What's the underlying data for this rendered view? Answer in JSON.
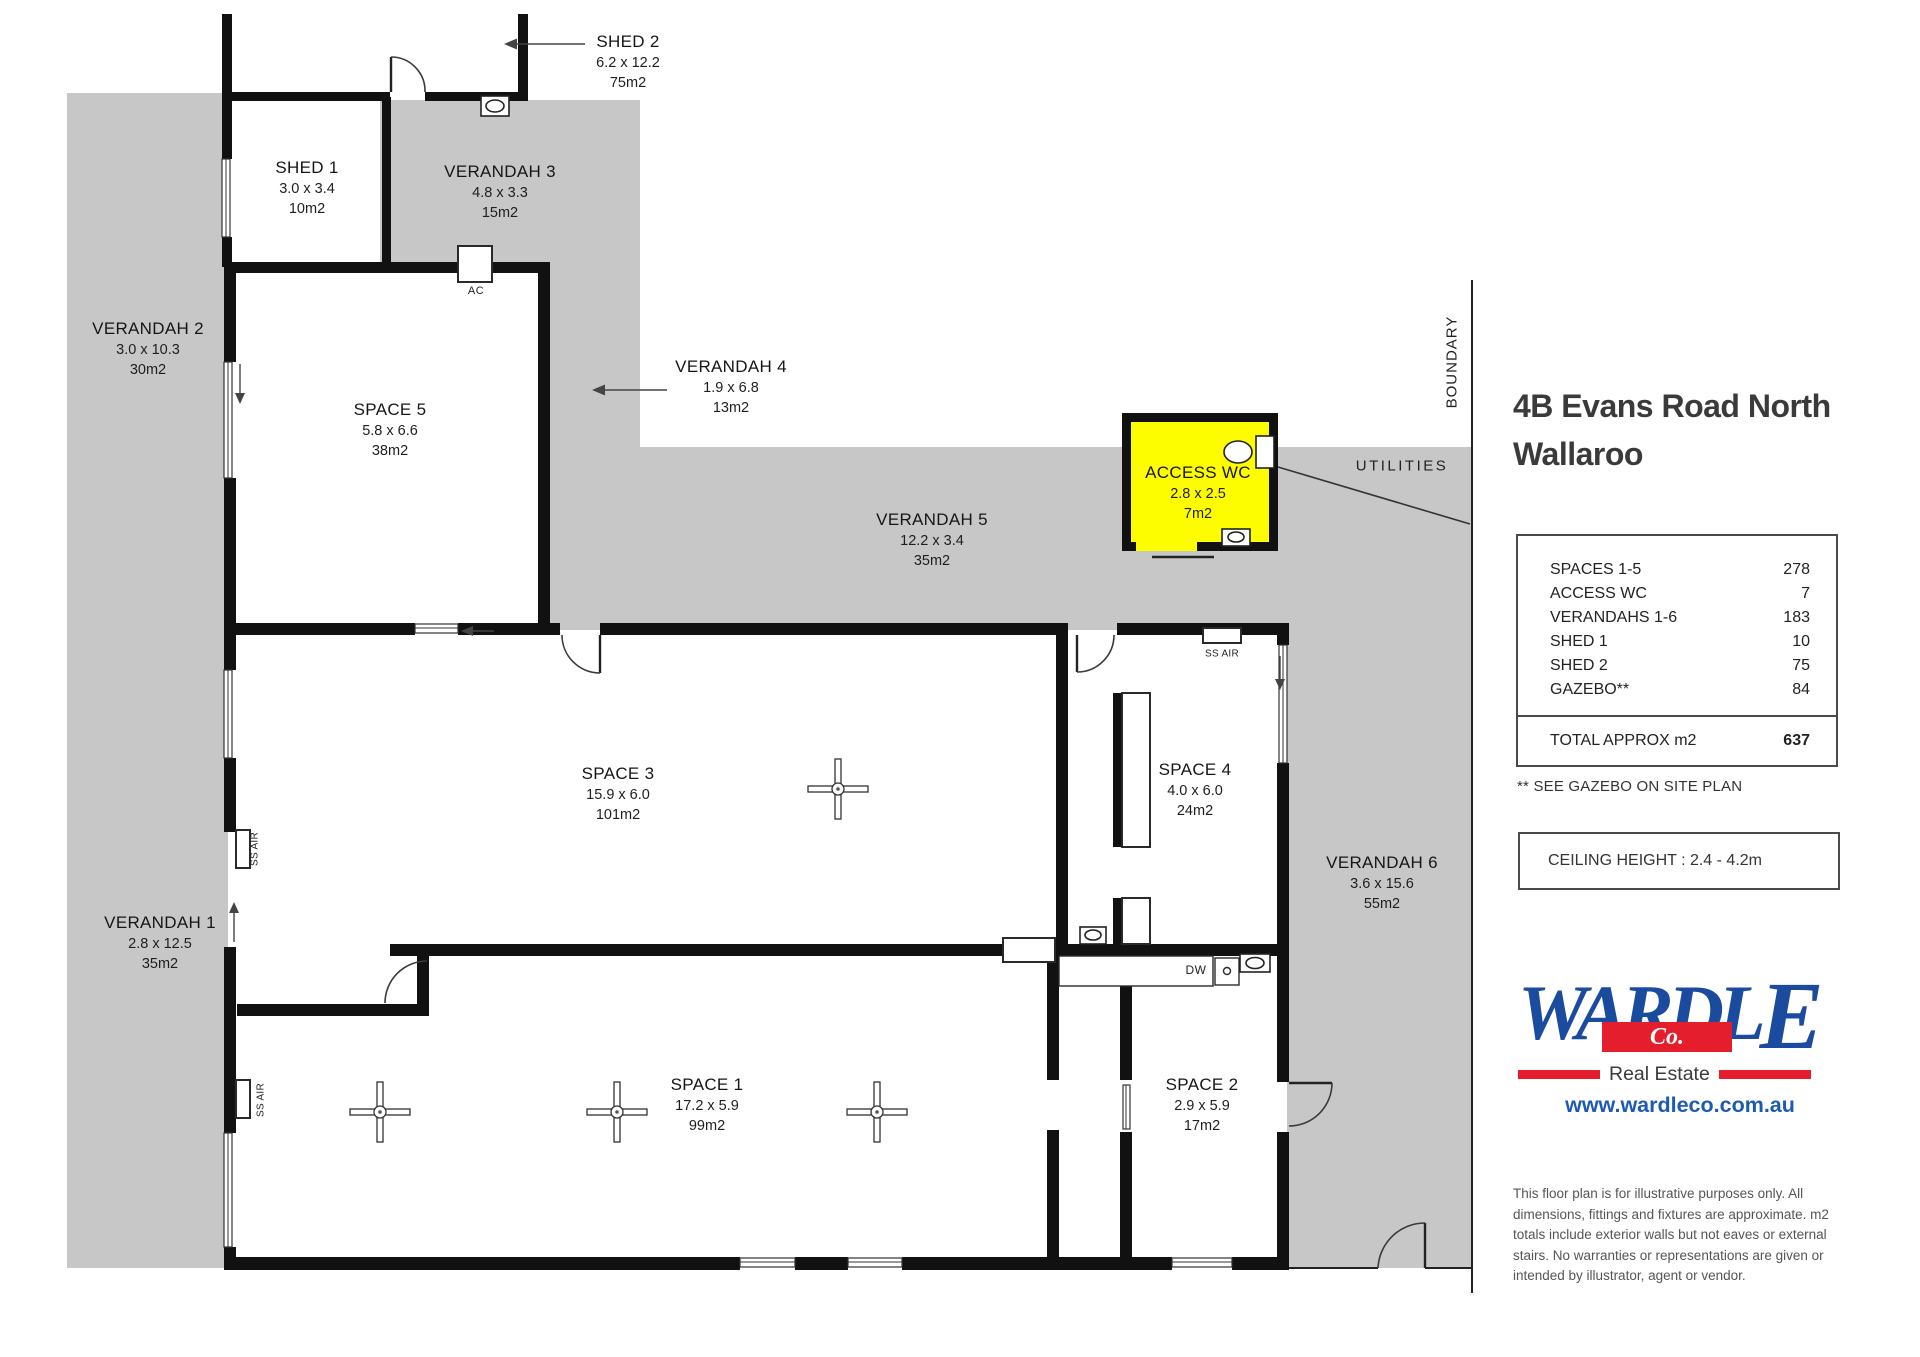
{
  "colors": {
    "wall": "#111111",
    "gray": "#c7c7c7",
    "yellow": "#fdfd00",
    "blue": "#1b4b9e",
    "red": "#e41e2d",
    "urlblue": "#1d5ab4"
  },
  "plan": {
    "rooms": [
      {
        "id": "shed-2",
        "name": "SHED 2",
        "dims": "6.2 x 12.2",
        "area": "75m2",
        "cx": 628,
        "y": 31
      },
      {
        "id": "shed-1",
        "name": "SHED 1",
        "dims": "3.0 x 3.4",
        "area": "10m2",
        "cx": 307,
        "y": 157
      },
      {
        "id": "verandah-3",
        "name": "VERANDAH 3",
        "dims": "4.8 x 3.3",
        "area": "15m2",
        "cx": 500,
        "y": 161
      },
      {
        "id": "verandah-2",
        "name": "VERANDAH 2",
        "dims": "3.0 x 10.3",
        "area": "30m2",
        "cx": 148,
        "y": 318
      },
      {
        "id": "verandah-4",
        "name": "VERANDAH 4",
        "dims": "1.9 x 6.8",
        "area": "13m2",
        "cx": 731,
        "y": 356
      },
      {
        "id": "space-5",
        "name": "SPACE 5",
        "dims": "5.8 x 6.6",
        "area": "38m2",
        "cx": 390,
        "y": 399
      },
      {
        "id": "verandah-5",
        "name": "VERANDAH 5",
        "dims": "12.2 x 3.4",
        "area": "35m2",
        "cx": 932,
        "y": 509
      },
      {
        "id": "access-wc",
        "name": "ACCESS WC",
        "dims": "2.8 x 2.5",
        "area": "7m2",
        "cx": 1198,
        "y": 462
      },
      {
        "id": "space-3",
        "name": "SPACE 3",
        "dims": "15.9 x 6.0",
        "area": "101m2",
        "cx": 618,
        "y": 763
      },
      {
        "id": "space-4",
        "name": "SPACE 4",
        "dims": "4.0 x 6.0",
        "area": "24m2",
        "cx": 1195,
        "y": 759
      },
      {
        "id": "verandah-6",
        "name": "VERANDAH 6",
        "dims": "3.6 x 15.6",
        "area": "55m2",
        "cx": 1382,
        "y": 852
      },
      {
        "id": "verandah-1",
        "name": "VERANDAH 1",
        "dims": "2.8 x 12.5",
        "area": "35m2",
        "cx": 160,
        "y": 912
      },
      {
        "id": "space-1",
        "name": "SPACE 1",
        "dims": "17.2 x 5.9",
        "area": "99m2",
        "cx": 707,
        "y": 1074
      },
      {
        "id": "space-2",
        "name": "SPACE 2",
        "dims": "2.9 x 5.9",
        "area": "17m2",
        "cx": 1202,
        "y": 1074
      }
    ],
    "annotations": [
      {
        "id": "utilities",
        "text": "UTILITIES",
        "x": 1402,
        "y": 466,
        "rot": 0,
        "size": 15,
        "spacing": 2.5
      },
      {
        "id": "boundary",
        "text": "BOUNDARY",
        "x": 1452,
        "y": 362,
        "rot": -90,
        "size": 15,
        "spacing": 1
      },
      {
        "id": "ac-unit",
        "text": "AC",
        "x": 476,
        "y": 291,
        "rot": 0,
        "size": 11,
        "spacing": 0.5
      },
      {
        "id": "dishwasher",
        "text": "DW",
        "x": 1196,
        "y": 970,
        "rot": 0,
        "size": 12,
        "spacing": 0.5
      },
      {
        "id": "ss-air-upper",
        "text": "SS AIR",
        "x": 255,
        "y": 849,
        "rot": -90,
        "size": 10,
        "spacing": 0.3
      },
      {
        "id": "ss-air-lower",
        "text": "SS AIR",
        "x": 261,
        "y": 1100,
        "rot": -90,
        "size": 10,
        "spacing": 0.3
      },
      {
        "id": "ss-air-space4",
        "text": "SS AIR",
        "x": 1222,
        "y": 654,
        "rot": 0,
        "size": 10,
        "spacing": 0.3
      }
    ]
  },
  "sidebar": {
    "title_line1": "4B Evans Road North",
    "title_line2": "Wallaroo",
    "area_table": {
      "rows": [
        {
          "label": "SPACES 1-5",
          "value": "278"
        },
        {
          "label": "ACCESS WC",
          "value": "7"
        },
        {
          "label": "VERANDAHS 1-6",
          "value": "183"
        },
        {
          "label": "SHED 1",
          "value": "10"
        },
        {
          "label": "SHED 2",
          "value": "75"
        },
        {
          "label": "GAZEBO**",
          "value": "84"
        }
      ],
      "total_label": "TOTAL APPROX m2",
      "total_value": "637"
    },
    "gazebo_note": "** SEE GAZEBO ON SITE PLAN",
    "ceiling_note": "CEILING HEIGHT : 2.4 - 4.2m",
    "logo": {
      "word": "WARDL",
      "last_letter": "E",
      "co": "Co.",
      "tagline": "Real Estate",
      "website": "www.wardleco.com.au"
    },
    "disclaimer": "This floor plan is for illustrative purposes only. All\ndimensions, fittings and fixtures are approximate. m2\ntotals include exterior walls but not eaves or external\nstairs. No warranties or representations are given or\nintended by illustrator, agent or vendor."
  }
}
